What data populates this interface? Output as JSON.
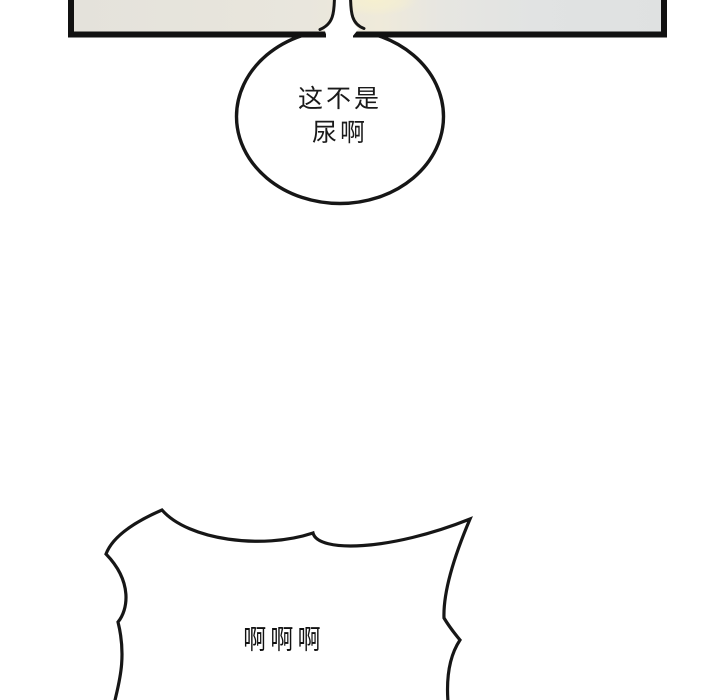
{
  "colors": {
    "ink": "#161616",
    "paper": "#ffffff"
  },
  "panel": {
    "border_color": "#111111",
    "gradient": [
      "#e4e2db",
      "#e9e6dd",
      "#efeada",
      "#e7e6e1",
      "#e1e3e3",
      "#dfe1e1"
    ],
    "glow_color": "#f6f0cf"
  },
  "speech_bubble": {
    "line1": "这不是",
    "line2": "尿啊",
    "fill": "#ffffff",
    "text_color": "#1a1a1a"
  },
  "scream_bubble": {
    "text": "啊啊啊",
    "fill": "#ffffff",
    "text_color": "#111111"
  }
}
